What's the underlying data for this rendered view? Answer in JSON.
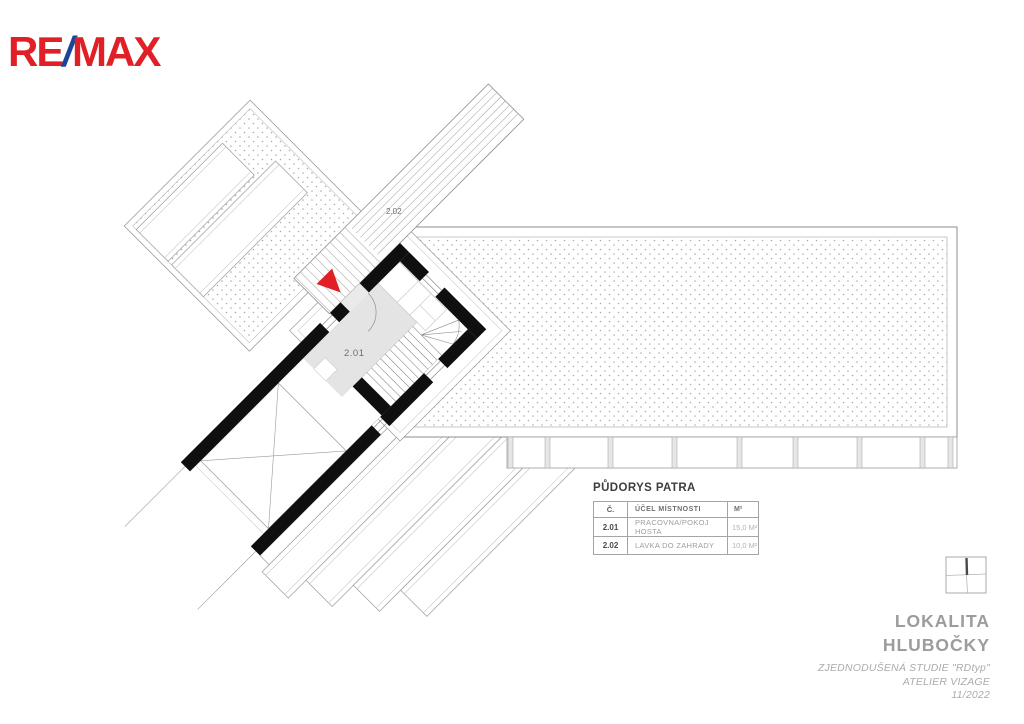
{
  "logo": {
    "re": "RE",
    "slash": "/",
    "max": "MAX",
    "red": "#e01f26",
    "blue": "#1b4598"
  },
  "plan": {
    "labels": [
      {
        "id": "room-upstairs",
        "text": "2.01"
      },
      {
        "id": "bridge",
        "text": "2.02"
      }
    ],
    "colors": {
      "wall": "#0f0f0f",
      "room_floor": "#e4e4e4",
      "entry_marker": "#e01f26",
      "dots": "#b3ab9a"
    }
  },
  "legend": {
    "title": "PŮDORYS PATRA",
    "columns": {
      "no": "Č.",
      "name": "ÚČEL MÍSTNOSTI",
      "area": "M²"
    },
    "rows": [
      {
        "no": "2.01",
        "name": "PRACOVNA/POKOJ HOSTA",
        "area": "15,0 M²"
      },
      {
        "no": "2.02",
        "name": "LAVKA DO ZAHRADY",
        "area": "10,0 M²"
      }
    ]
  },
  "titleblock": {
    "location1": "LOKALITA",
    "location2": "HLUBOČKY",
    "note1": "ZJEDNODUŠENÁ STUDIE \"RDtyp\"",
    "note2": "ATELIER VIZAGE",
    "note3": "11/2022"
  }
}
